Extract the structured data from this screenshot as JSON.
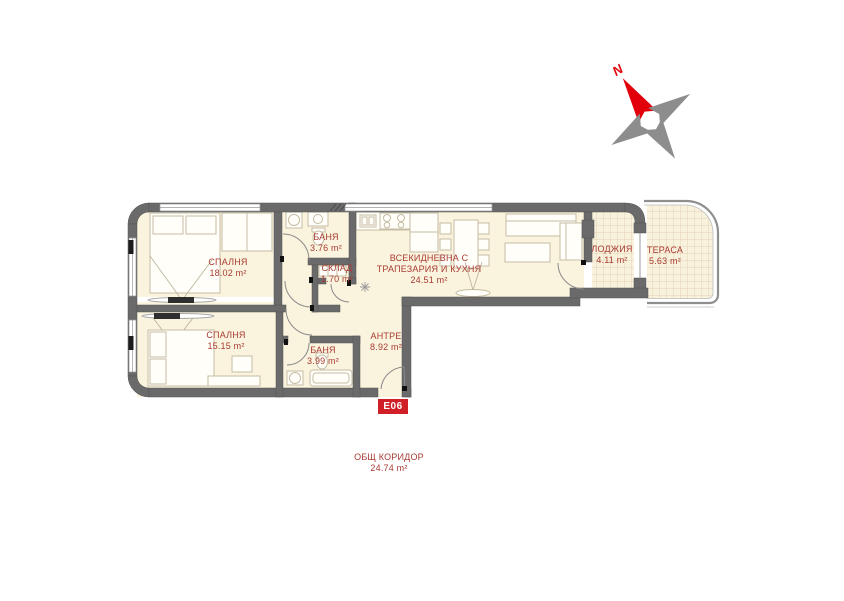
{
  "compass": {
    "north_label": "N"
  },
  "unit": {
    "label": "E06"
  },
  "colors": {
    "label_red": "#a93b33",
    "badge_red": "#d01f26",
    "wall_gray": "#6a6a6a",
    "floor_cream": "#faf3dd",
    "compass_red": "#e2000b",
    "compass_gray": "#8d8d8d"
  },
  "rooms": [
    {
      "key": "bedroom-1",
      "name": "СПАЛНЯ",
      "area": "18.02 m²"
    },
    {
      "key": "bathroom-1",
      "name": "БАНЯ",
      "area": "3.76 m²"
    },
    {
      "key": "storage",
      "name": "СКЛАД",
      "area": "1.70 m²"
    },
    {
      "key": "living",
      "name": "ВСЕКИДНЕВНА С ТРАПЕЗАРИЯ И КУХНЯ",
      "area": "24.51 m²"
    },
    {
      "key": "loggia",
      "name": "ЛОДЖИЯ",
      "area": "4.11 m²"
    },
    {
      "key": "terrace",
      "name": "ТЕРАСА",
      "area": "5.63 m²"
    },
    {
      "key": "bedroom-2",
      "name": "СПАЛНЯ",
      "area": "15.15 m²"
    },
    {
      "key": "bathroom-2",
      "name": "БАНЯ",
      "area": "3.99 m²"
    },
    {
      "key": "entry",
      "name": "АНТРЕ",
      "area": "8.92 m²"
    },
    {
      "key": "common-corridor",
      "name": "ОБЩ КОРИДОР",
      "area": "24.74 m²"
    }
  ]
}
